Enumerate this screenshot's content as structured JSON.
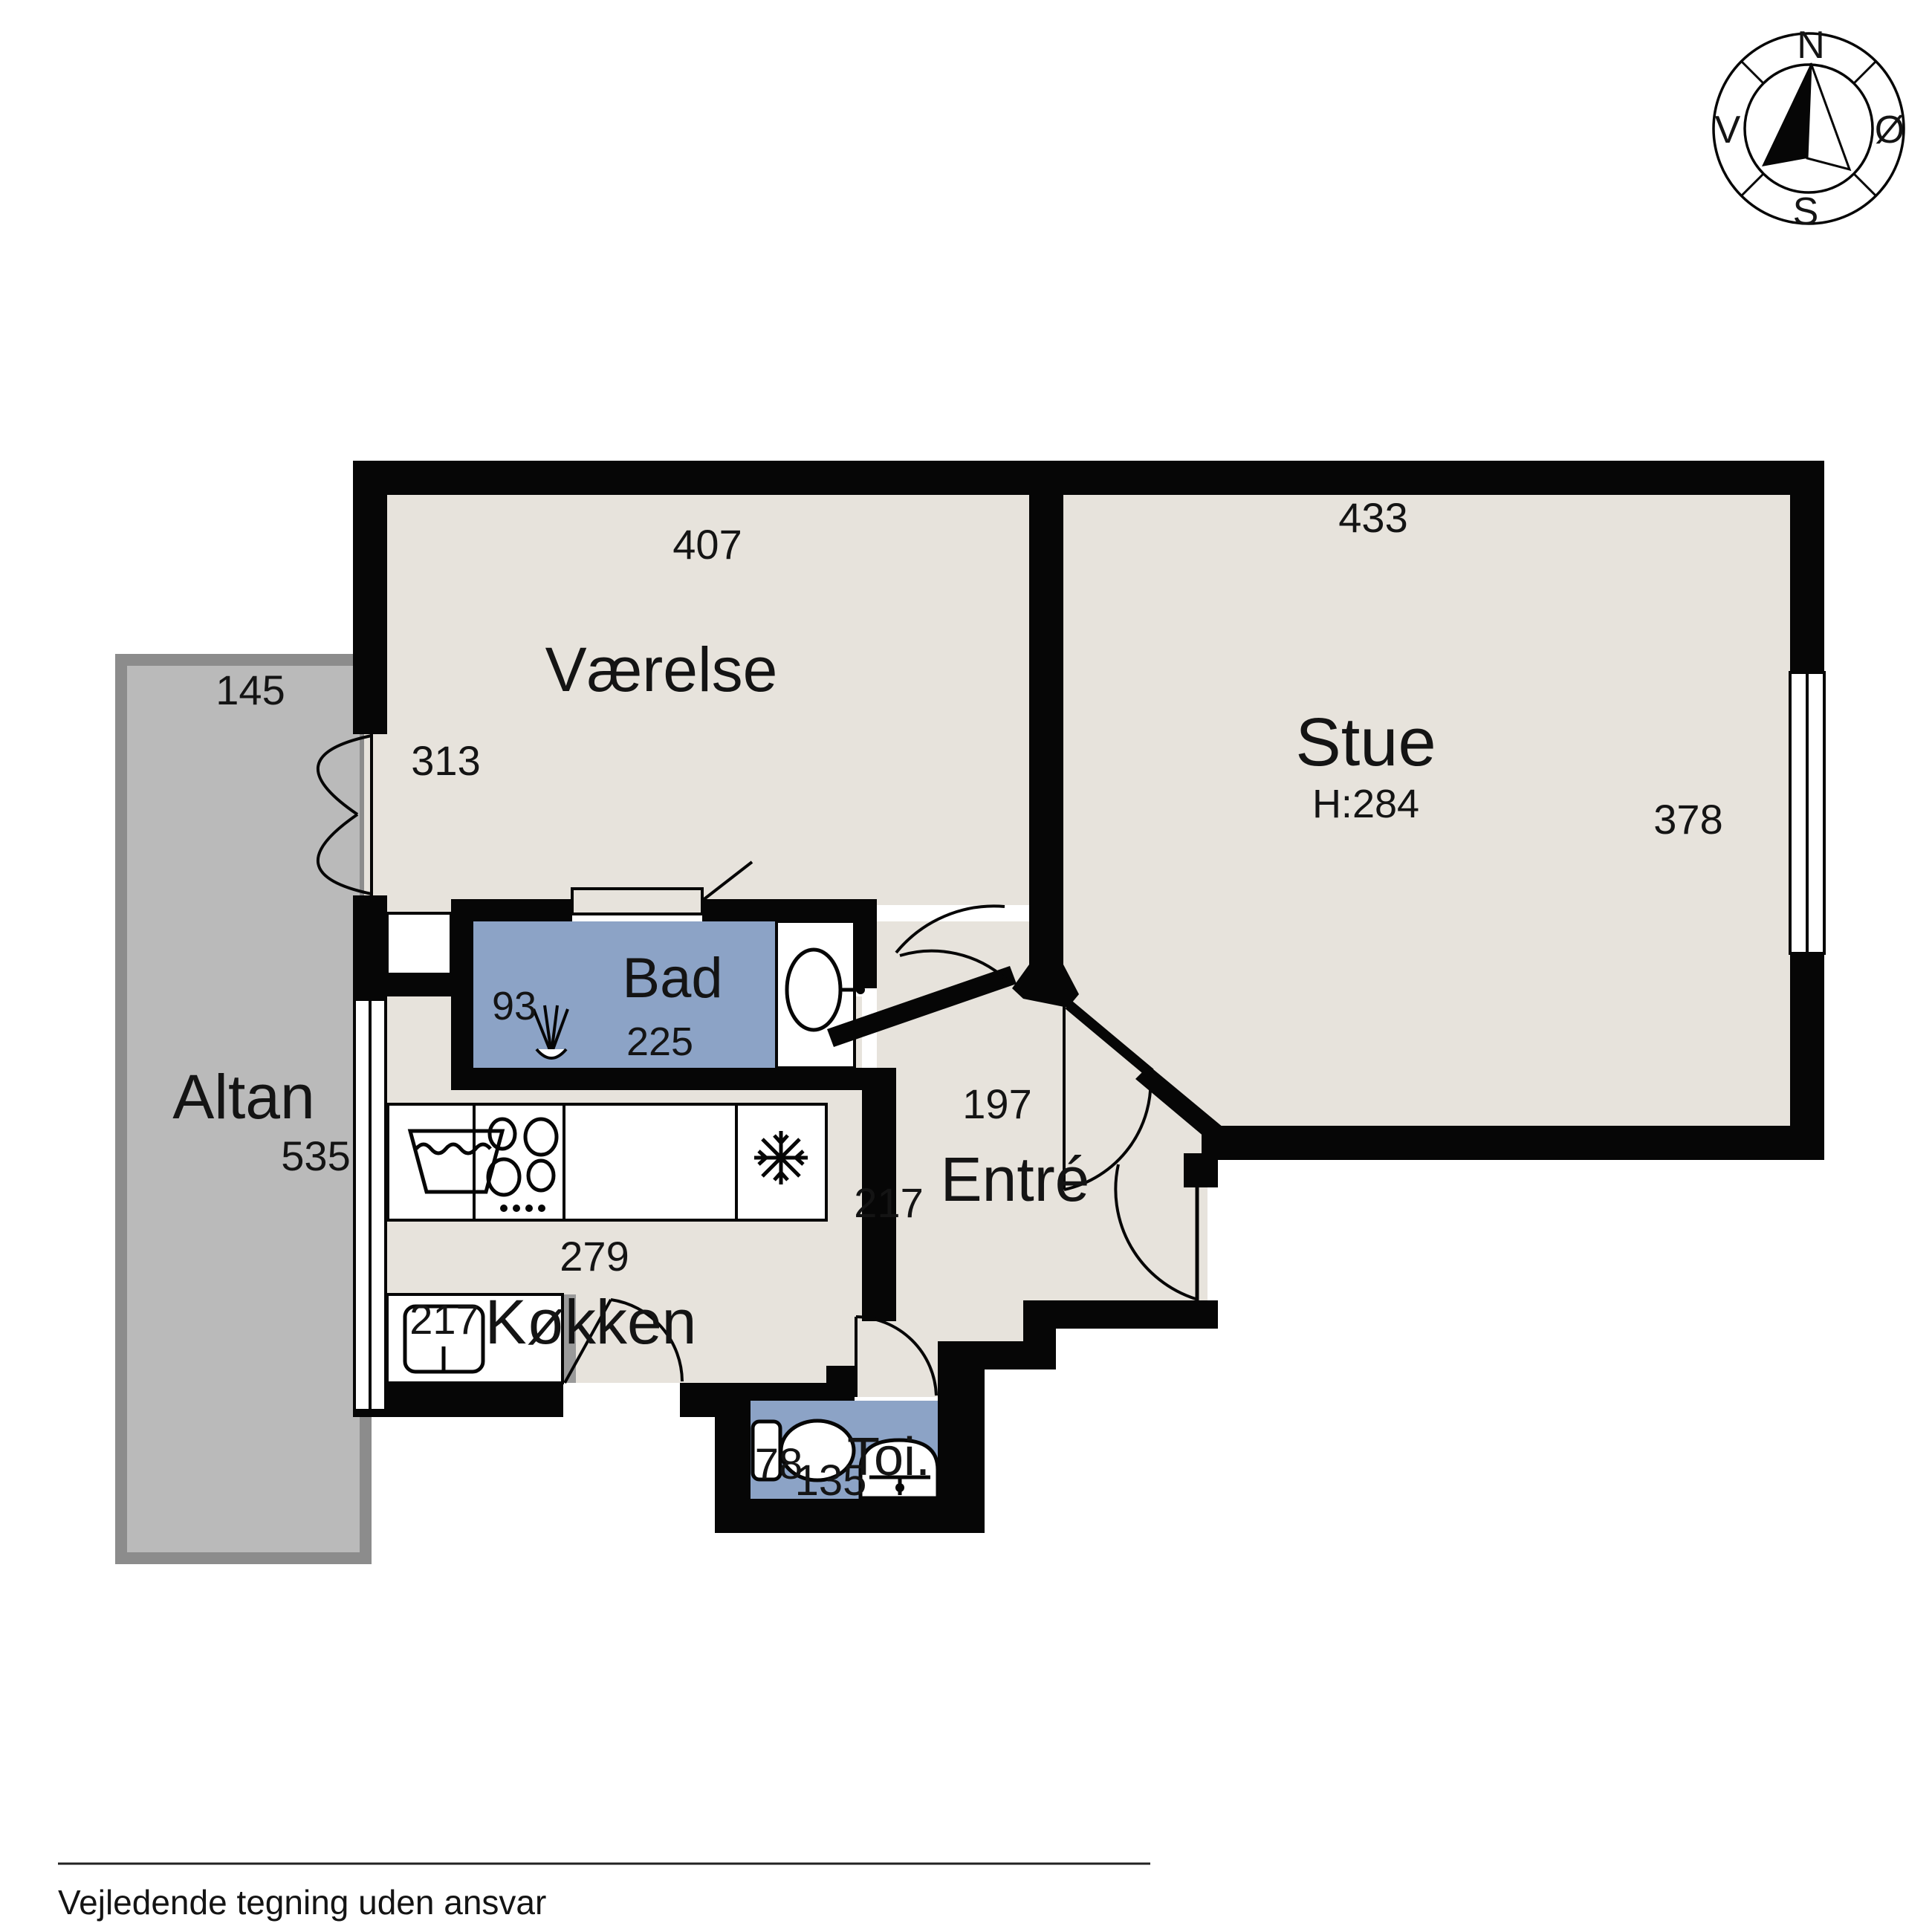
{
  "footer": {
    "disclaimer": "Vejledende tegning uden ansvar"
  },
  "compass": {
    "north": "N",
    "south": "S",
    "west": "V",
    "east": "Ø"
  },
  "rooms": {
    "vaerelse": {
      "label": "Værelse",
      "dim_top": "407",
      "dim_left": "313"
    },
    "stue": {
      "label": "Stue",
      "ceiling_height": "H:284",
      "dim_top": "433",
      "dim_right": "378"
    },
    "bad": {
      "label": "Bad",
      "dim_left": "93",
      "dim_bottom": "225"
    },
    "altan": {
      "label": "Altan",
      "dim_top": "145",
      "dim_right": "535"
    },
    "kokken": {
      "label": "Køkken",
      "dim_top": "279",
      "dim_left": "217"
    },
    "entre": {
      "label": "Entré",
      "dim_top": "197",
      "dim_left": "217"
    },
    "toi": {
      "label": "Toi.",
      "dim_width": "78",
      "dim_bottom": "135"
    }
  },
  "icons": {
    "compass_rose": "compass-rose-icon",
    "shower": "shower-icon",
    "washbasin_bad": "washbasin-icon",
    "toilet": "toilet-icon",
    "washbasin_toi": "washbasin-icon",
    "washing_machine": "washing-machine-icon",
    "cooktop": "cooktop-icon",
    "refrigerator": "refrigerator-snowflake-icon",
    "kitchen_sink": "kitchen-sink-icon"
  },
  "colors": {
    "floor": "#E7E3DC",
    "wet_room": "#8CA3C6",
    "balcony_fill": "#BABABA",
    "balcony_border": "#8C8C8C",
    "wall": "#060606",
    "background": "#FFFFFF",
    "text": "#141414",
    "shadow": "#9A9A9A"
  }
}
